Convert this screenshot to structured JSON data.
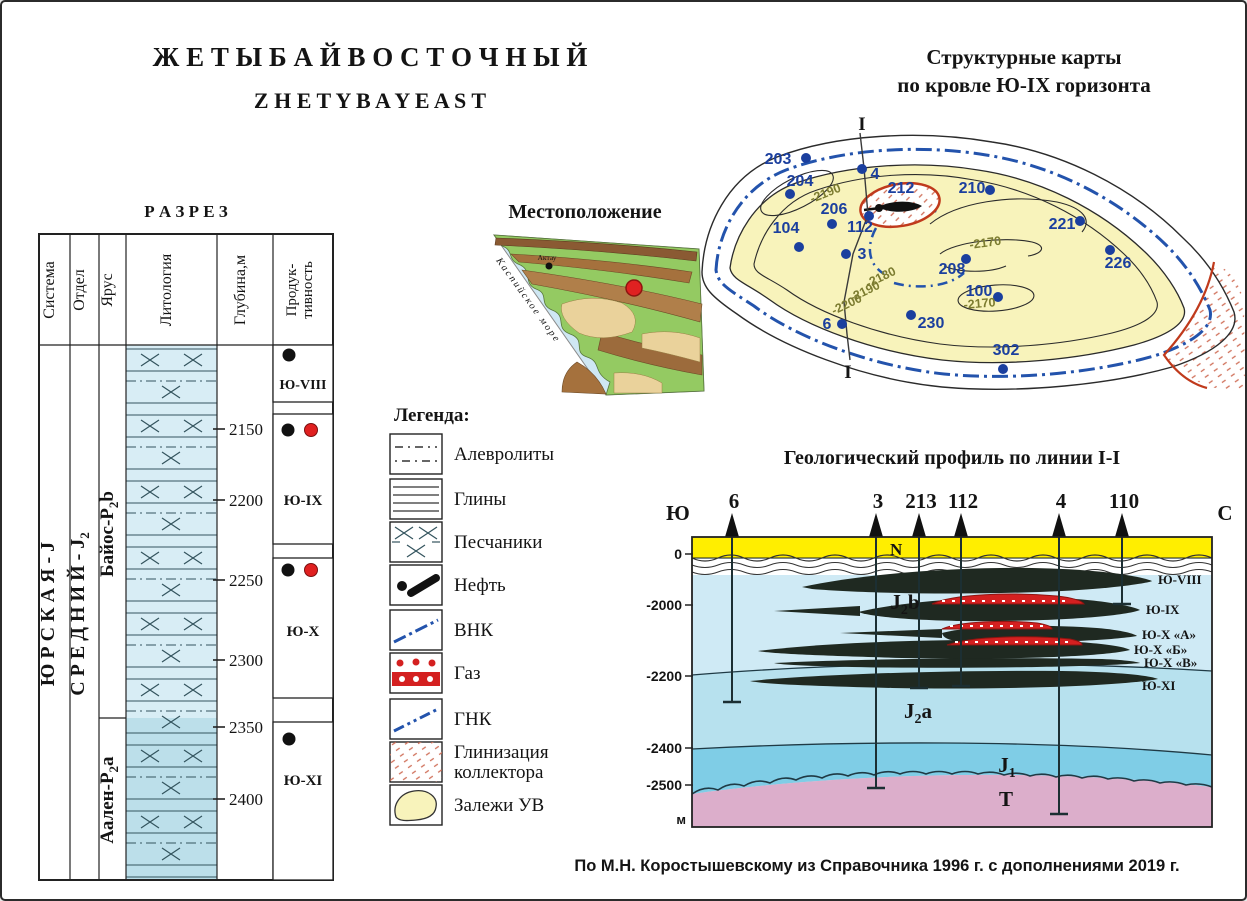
{
  "colors": {
    "title_en": "#b5491b",
    "well_blue": "#1b3f9e",
    "vnk_goc_blue": "#2353ac",
    "deposit_yellow": "#f8f3bb",
    "gas_red": "#d42020",
    "oil_black": "#1f2921",
    "neogene_yellow": "#ffee00",
    "j2b_blue_light": "#cfeaf5",
    "j2a_blue": "#b7e1ee",
    "j1_blue": "#7fcde6",
    "triassic_pink": "#dcaecb",
    "lithology_blue": "#d8edf5",
    "shaling_red": "#c03a1c"
  },
  "figure": {
    "title_ru": "Ж Е Т Ы Б А Й   В О С Т О Ч Н Ы Й",
    "title_en": "Z H E T Y B A Y   E A S T",
    "attribution": "По М.Н. Коростышевскому из Справочника 1996 г. с дополнениями 2019 г."
  },
  "strat_column": {
    "title": "Р А З Р Е З",
    "headers": [
      "Система",
      "Отдел",
      "Ярус",
      "Литология",
      "Глубина,м",
      "Продук-тивность"
    ],
    "header_prod_line1": "Продук-",
    "header_prod_line2": "тивность",
    "system": {
      "text": "Ю Р С К А Я  -  J"
    },
    "series": {
      "pre": "С Р Е Д Н И Й -  J",
      "sub": "2"
    },
    "stage_top": {
      "pre": "Байос-Р",
      "sub": "2",
      "post": "b"
    },
    "stage_bottom": {
      "pre": "Аален-Р",
      "sub": "2",
      "post": "a"
    },
    "depth_ticks": [
      "2150",
      "2200",
      "2250",
      "2300",
      "2350",
      "2400"
    ],
    "horizons": [
      {
        "label": "Ю-VIII",
        "fluids": [
          "нефть"
        ]
      },
      {
        "label": "Ю-IX",
        "fluids": [
          "нефть",
          "газ"
        ]
      },
      {
        "label": "Ю-X",
        "fluids": [
          "нефть",
          "газ"
        ]
      },
      {
        "label": "Ю-XI",
        "fluids": [
          "нефть"
        ]
      }
    ]
  },
  "location_map": {
    "title": "Местоположение",
    "sea_label": "Каспийское море",
    "city_label": "Актау"
  },
  "legend": {
    "title": "Легенда:",
    "items": [
      {
        "key": "siltstone",
        "label": "Алевролиты"
      },
      {
        "key": "clay",
        "label": "Глины"
      },
      {
        "key": "sandstone",
        "label": "Песчаники"
      },
      {
        "key": "oil",
        "label": "Нефть"
      },
      {
        "key": "owc",
        "label": "ВНК"
      },
      {
        "key": "gas",
        "label": "Газ"
      },
      {
        "key": "goc",
        "label": "ГНК"
      },
      {
        "key": "shaling",
        "label": "Глинизация коллектора"
      },
      {
        "key": "hc_deposits",
        "label": "Залежи УВ"
      }
    ],
    "shaling_line1": "Глинизация",
    "shaling_line2": "коллектора"
  },
  "structural_map": {
    "title_line1": "Структурные карты",
    "title_line2": "по кровле Ю-IX горизонта",
    "section_label_top": "I",
    "section_label_bottom": "I",
    "wells": [
      "203",
      "204",
      "4",
      "212",
      "210",
      "206",
      "112",
      "104",
      "3",
      "221",
      "226",
      "208",
      "100",
      "230",
      "302",
      "6"
    ],
    "contour_labels": [
      "-2190",
      "-2180",
      "-2190",
      "-2200",
      "-2170",
      "-2170"
    ]
  },
  "profile": {
    "title": "Геологический профиль по линии I-I",
    "south_label": "Ю",
    "north_label": "С",
    "n_label": "N",
    "meters_label": "м",
    "depth_labels": [
      "0",
      "-2000",
      "-2200",
      "-2400",
      "-2500"
    ],
    "wells": [
      "6",
      "3",
      "213",
      "112",
      "4",
      "110"
    ],
    "units": {
      "j2b": {
        "main": "J",
        "sub": "2",
        "post": "b"
      },
      "j2a": {
        "main": "J",
        "sub": "2",
        "post": "a"
      },
      "j1": {
        "main": "J",
        "sub": "1",
        "post": ""
      },
      "t": "T"
    },
    "lens_labels": [
      "Ю-VIII",
      "Ю-IX",
      "Ю-X «А»",
      "Ю-X «Б»",
      "Ю-X «В»",
      "Ю-XI"
    ]
  }
}
